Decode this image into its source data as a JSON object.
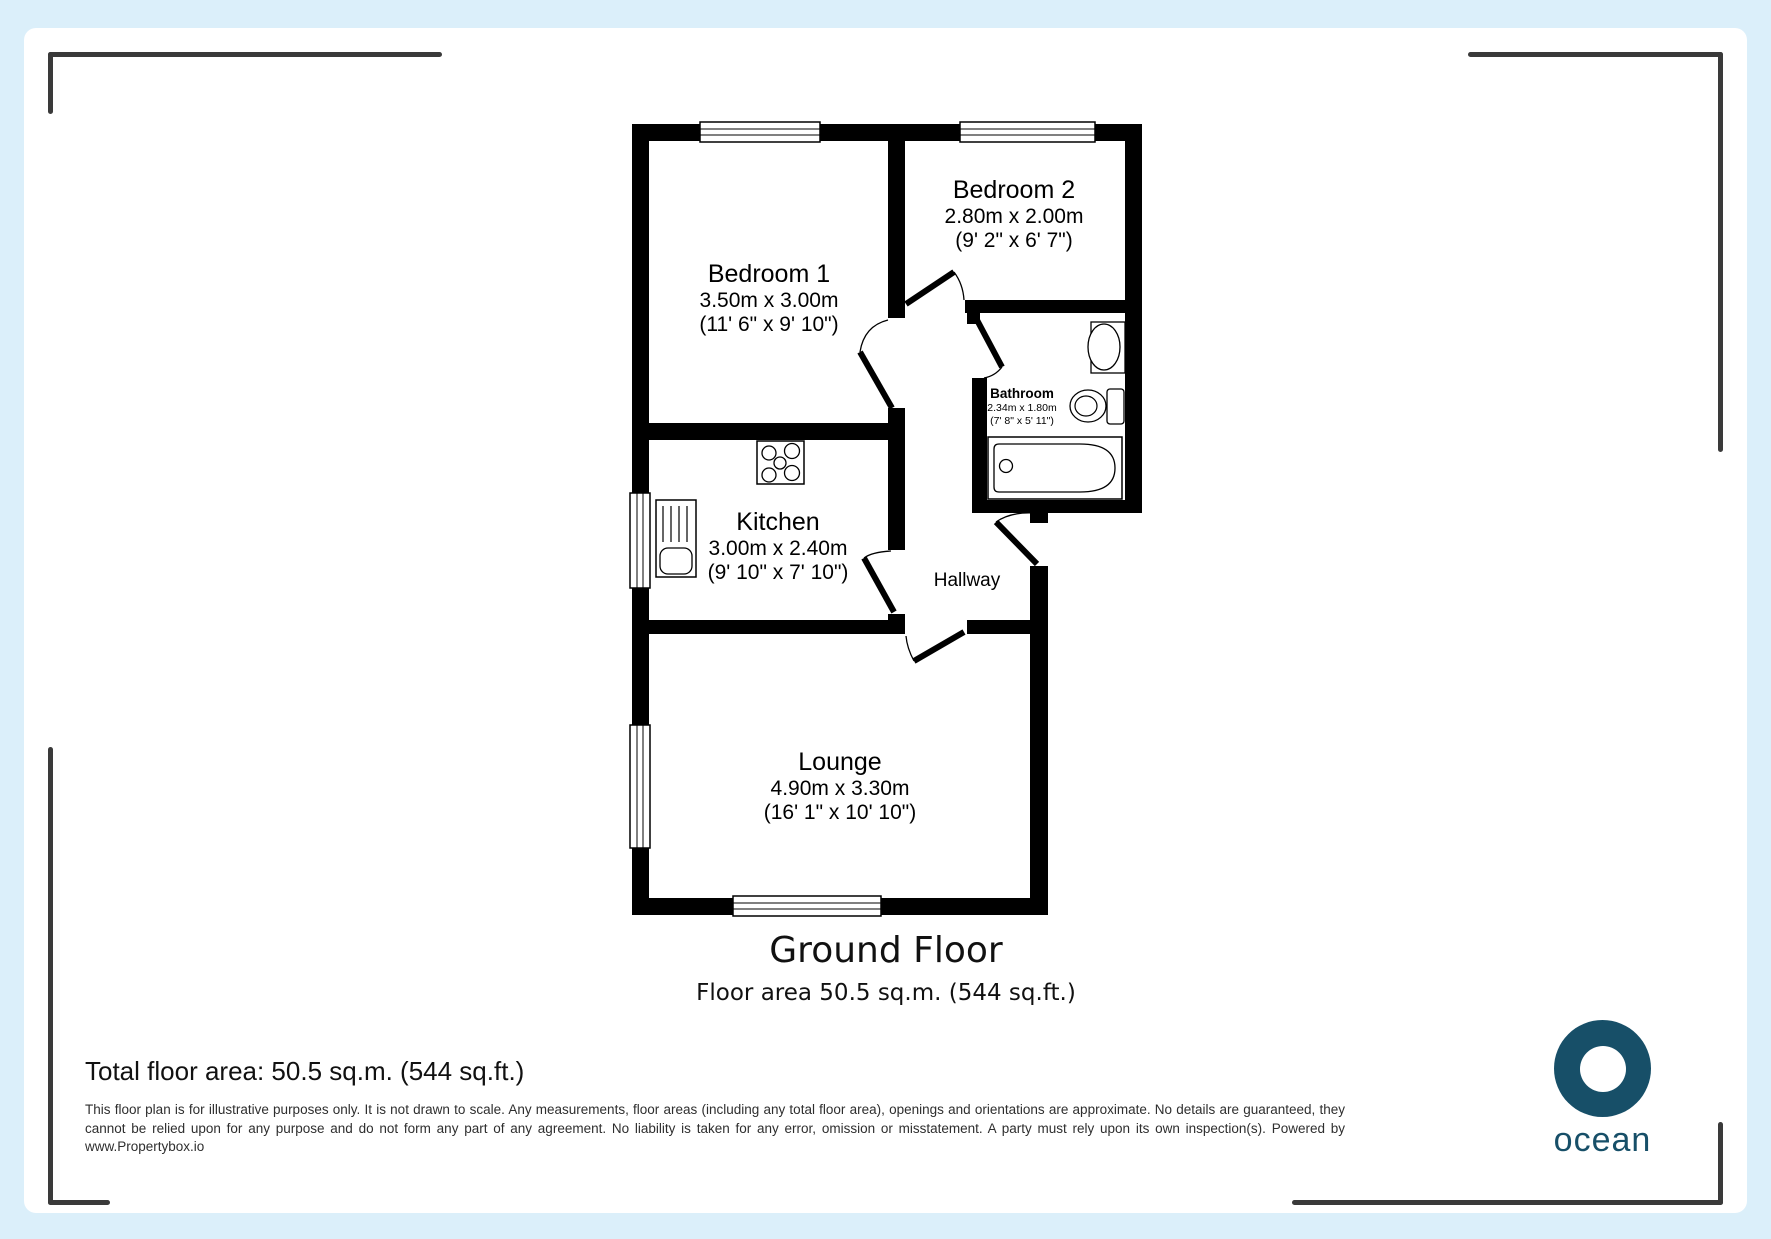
{
  "canvas": {
    "background_color": "#dbeffa",
    "sheet_color": "#ffffff",
    "wall_color": "#000000",
    "bracket_color": "#3a3a3a"
  },
  "floor_plan": {
    "rooms": [
      {
        "name": "Bedroom 1",
        "metric": "3.50m x 3.00m",
        "imperial": "(11' 6\" x 9' 10\")"
      },
      {
        "name": "Bedroom 2",
        "metric": "2.80m x 2.00m",
        "imperial": "(9' 2\" x 6' 7\")"
      },
      {
        "name": "Bathroom",
        "metric": "2.34m x 1.80m",
        "imperial": "(7' 8\" x 5' 11\")"
      },
      {
        "name": "Kitchen",
        "metric": "3.00m x 2.40m",
        "imperial": "(9' 10\" x 7' 10\")"
      },
      {
        "name": "Hallway"
      },
      {
        "name": "Lounge",
        "metric": "4.90m x 3.30m",
        "imperial": "(16' 1\" x 10' 10\")"
      }
    ],
    "title": "Ground Floor",
    "area_caption": "Floor area 50.5 sq.m. (544 sq.ft.)"
  },
  "footer": {
    "total_area": "Total floor area: 50.5 sq.m. (544 sq.ft.)",
    "disclaimer": "This floor plan is for illustrative purposes only. It is not drawn to scale. Any measurements, floor areas (including any total floor area), openings and orientations are approximate. No details are guaranteed, they cannot be relied upon for any purpose and do not form any part of any agreement. No liability is taken for any error, omission or misstatement. A party must rely upon its own inspection(s). Powered by www.Propertybox.io",
    "logo_text": "ocean",
    "logo_color": "#174f68"
  }
}
